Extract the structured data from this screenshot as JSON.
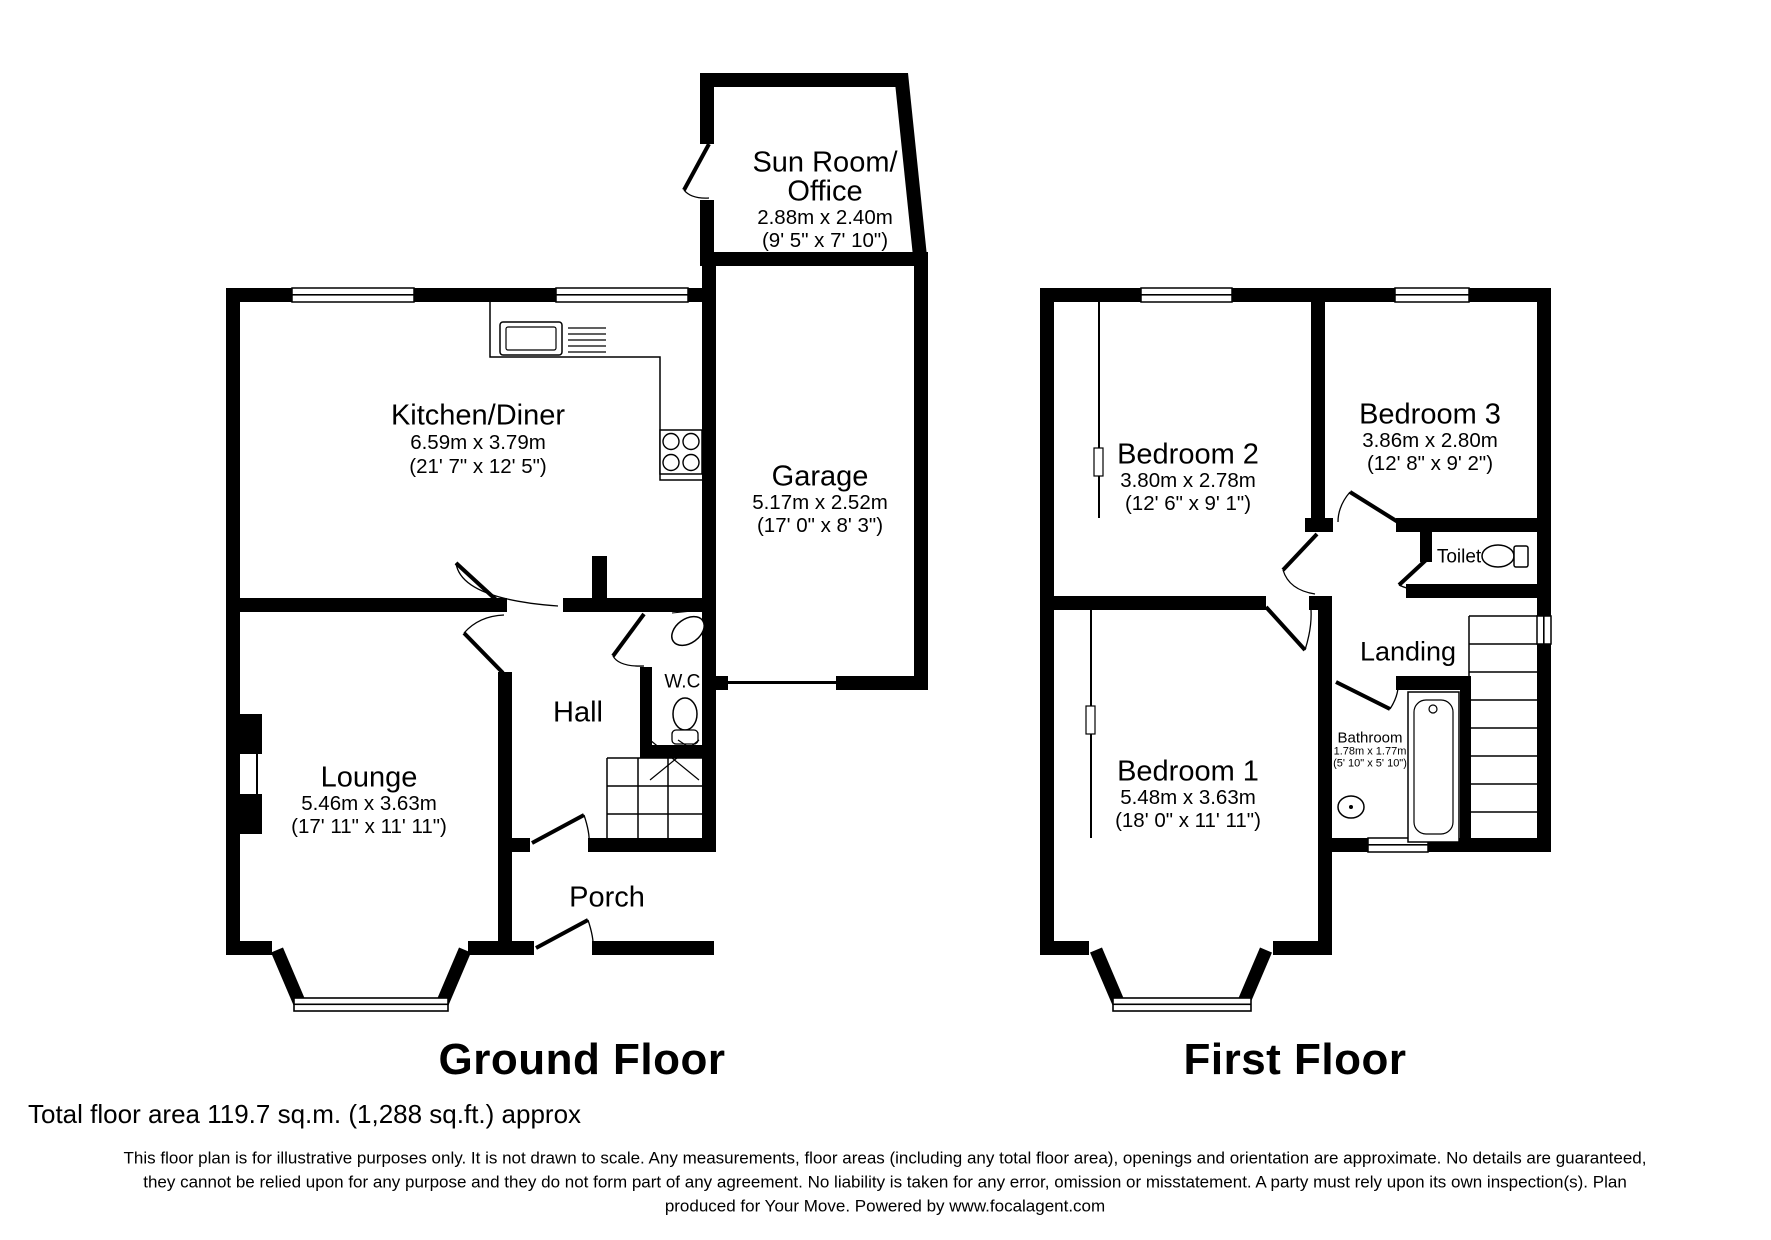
{
  "ground_floor": {
    "title": "Ground Floor",
    "rooms": {
      "sun_room": {
        "name_line1": "Sun Room/",
        "name_line2": "Office",
        "dims_metric": "2.88m x 2.40m",
        "dims_imperial": "(9' 5\" x 7' 10\")"
      },
      "kitchen_diner": {
        "name": "Kitchen/Diner",
        "dims_metric": "6.59m x 3.79m",
        "dims_imperial": "(21' 7\" x 12' 5\")"
      },
      "garage": {
        "name": "Garage",
        "dims_metric": "5.17m x 2.52m",
        "dims_imperial": "(17' 0\" x 8' 3\")"
      },
      "lounge": {
        "name": "Lounge",
        "dims_metric": "5.46m x 3.63m",
        "dims_imperial": "(17' 11\" x 11' 11\")"
      },
      "hall": {
        "name": "Hall"
      },
      "wc": {
        "name": "W.C."
      },
      "porch": {
        "name": "Porch"
      }
    }
  },
  "first_floor": {
    "title": "First Floor",
    "rooms": {
      "bedroom_2": {
        "name": "Bedroom 2",
        "dims_metric": "3.80m x 2.78m",
        "dims_imperial": "(12' 6\" x 9' 1\")"
      },
      "bedroom_3": {
        "name": "Bedroom 3",
        "dims_metric": "3.86m x 2.80m",
        "dims_imperial": "(12' 8\" x 9' 2\")"
      },
      "bedroom_1": {
        "name": "Bedroom 1",
        "dims_metric": "5.48m x 3.63m",
        "dims_imperial": "(18' 0\" x 11' 11\")"
      },
      "bathroom": {
        "name": "Bathroom",
        "dims_metric": "1.78m x 1.77m",
        "dims_imperial": "(5' 10\" x 5' 10\")"
      },
      "toilet": {
        "name": "Toilet"
      },
      "landing": {
        "name": "Landing"
      }
    }
  },
  "footer": {
    "total_area": "Total floor area 119.7 sq.m. (1,288 sq.ft.) approx",
    "disclaimer_line1": "This floor plan is for illustrative purposes only. It is not drawn to scale. Any measurements, floor areas (including any total floor area), openings and orientation are approximate. No details are guaranteed,",
    "disclaimer_line2": "they cannot be relied upon for any purpose and they do not form part of any agreement. No liability is taken for any error, omission or misstatement. A party must rely upon its own inspection(s).  Plan",
    "disclaimer_line3": "produced for Your Move. Powered by www.focalagent.com"
  },
  "colors": {
    "wall": "#000000",
    "background": "#ffffff"
  }
}
